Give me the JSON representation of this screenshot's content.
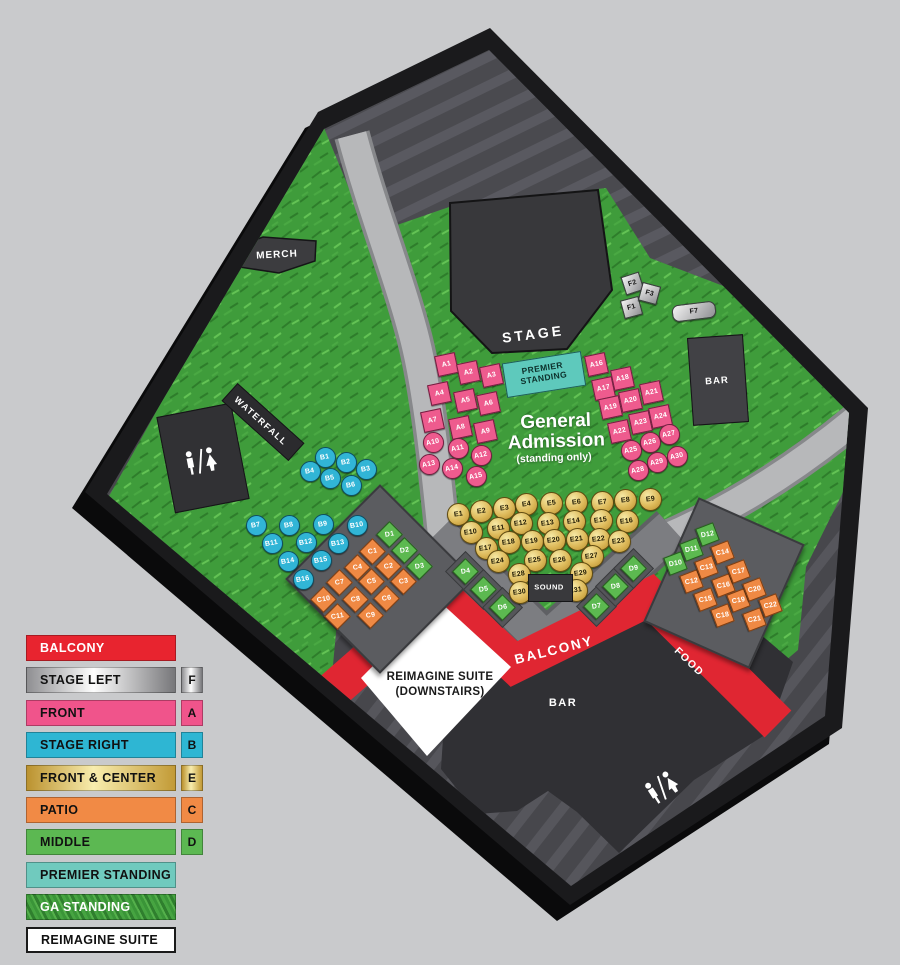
{
  "map": {
    "labels": {
      "merch": "MERCH",
      "stage": "STAGE",
      "premier": "PREMIER STANDING",
      "ga_title": "General Admission",
      "ga_sub": "(standing only)",
      "waterfall": "WATERFALL",
      "bar_upper": "BAR",
      "bar_lower": "BAR",
      "sound": "SOUND",
      "balcony": "BALCONY",
      "food": "FOOD",
      "suite": "REIMAGINE SUITE (DOWNSTAIRS)"
    },
    "colors": {
      "balcony_red": "#e8242f",
      "front_pink": "#ee5b8e",
      "stage_right_cyan": "#31b5d6",
      "front_center_gold": "#ddb959",
      "patio_orange": "#ef8944",
      "middle_green": "#5cb950",
      "premier_teal": "#70cabe",
      "grass_green": "#3f9c3b",
      "stage_left_silver": "#c0c0c2"
    },
    "sections": {
      "front": {
        "name": "FRONT",
        "seats": [
          {
            "id": "A1",
            "x": 446,
            "y": 364,
            "sh": "sq"
          },
          {
            "id": "A2",
            "x": 468,
            "y": 372,
            "sh": "sq"
          },
          {
            "id": "A3",
            "x": 491,
            "y": 375,
            "sh": "sq"
          },
          {
            "id": "A4",
            "x": 439,
            "y": 393,
            "sh": "sq"
          },
          {
            "id": "A5",
            "x": 465,
            "y": 400,
            "sh": "sq"
          },
          {
            "id": "A6",
            "x": 488,
            "y": 403,
            "sh": "sq"
          },
          {
            "id": "A7",
            "x": 432,
            "y": 420,
            "sh": "sq"
          },
          {
            "id": "A8",
            "x": 460,
            "y": 427,
            "sh": "sq"
          },
          {
            "id": "A9",
            "x": 485,
            "y": 431,
            "sh": "sq"
          },
          {
            "id": "A10",
            "x": 433,
            "y": 442,
            "sh": "ci"
          },
          {
            "id": "A11",
            "x": 458,
            "y": 448,
            "sh": "ci"
          },
          {
            "id": "A12",
            "x": 481,
            "y": 455,
            "sh": "ci"
          },
          {
            "id": "A13",
            "x": 429,
            "y": 464,
            "sh": "ci"
          },
          {
            "id": "A14",
            "x": 452,
            "y": 468,
            "sh": "ci"
          },
          {
            "id": "A15",
            "x": 476,
            "y": 476,
            "sh": "ci"
          },
          {
            "id": "A16",
            "x": 596,
            "y": 364,
            "sh": "sq"
          },
          {
            "id": "A17",
            "x": 603,
            "y": 388,
            "sh": "sq"
          },
          {
            "id": "A18",
            "x": 622,
            "y": 378,
            "sh": "sq"
          },
          {
            "id": "A19",
            "x": 610,
            "y": 407,
            "sh": "sq"
          },
          {
            "id": "A20",
            "x": 630,
            "y": 400,
            "sh": "sq"
          },
          {
            "id": "A21",
            "x": 651,
            "y": 392,
            "sh": "sq"
          },
          {
            "id": "A22",
            "x": 619,
            "y": 431,
            "sh": "sq"
          },
          {
            "id": "A23",
            "x": 640,
            "y": 422,
            "sh": "sq"
          },
          {
            "id": "A24",
            "x": 660,
            "y": 416,
            "sh": "sq"
          },
          {
            "id": "A25",
            "x": 631,
            "y": 450,
            "sh": "ci"
          },
          {
            "id": "A26",
            "x": 650,
            "y": 442,
            "sh": "ci"
          },
          {
            "id": "A27",
            "x": 669,
            "y": 434,
            "sh": "ci"
          },
          {
            "id": "A28",
            "x": 638,
            "y": 470,
            "sh": "ci"
          },
          {
            "id": "A29",
            "x": 657,
            "y": 462,
            "sh": "ci"
          },
          {
            "id": "A30",
            "x": 677,
            "y": 456,
            "sh": "ci"
          }
        ]
      },
      "stage_right": {
        "name": "STAGE RIGHT",
        "seats": [
          {
            "id": "B1",
            "x": 325,
            "y": 457
          },
          {
            "id": "B2",
            "x": 346,
            "y": 462
          },
          {
            "id": "B3",
            "x": 366,
            "y": 469
          },
          {
            "id": "B4",
            "x": 310,
            "y": 471
          },
          {
            "id": "B5",
            "x": 330,
            "y": 478
          },
          {
            "id": "B6",
            "x": 351,
            "y": 485
          },
          {
            "id": "B7",
            "x": 256,
            "y": 525
          },
          {
            "id": "B8",
            "x": 289,
            "y": 525
          },
          {
            "id": "B9",
            "x": 323,
            "y": 524
          },
          {
            "id": "B10",
            "x": 357,
            "y": 525
          },
          {
            "id": "B11",
            "x": 272,
            "y": 543
          },
          {
            "id": "B12",
            "x": 306,
            "y": 542
          },
          {
            "id": "B13",
            "x": 338,
            "y": 543
          },
          {
            "id": "B14",
            "x": 288,
            "y": 561
          },
          {
            "id": "B15",
            "x": 321,
            "y": 560
          },
          {
            "id": "B16",
            "x": 303,
            "y": 579
          }
        ]
      },
      "front_center": {
        "name": "FRONT & CENTER",
        "seats": [
          {
            "id": "E1",
            "x": 458,
            "y": 514
          },
          {
            "id": "E2",
            "x": 481,
            "y": 511
          },
          {
            "id": "E3",
            "x": 504,
            "y": 508
          },
          {
            "id": "E4",
            "x": 526,
            "y": 504
          },
          {
            "id": "E5",
            "x": 551,
            "y": 503
          },
          {
            "id": "E6",
            "x": 576,
            "y": 502
          },
          {
            "id": "E7",
            "x": 602,
            "y": 502
          },
          {
            "id": "E8",
            "x": 625,
            "y": 500
          },
          {
            "id": "E9",
            "x": 650,
            "y": 499
          },
          {
            "id": "E10",
            "x": 471,
            "y": 532
          },
          {
            "id": "E11",
            "x": 498,
            "y": 528
          },
          {
            "id": "E12",
            "x": 521,
            "y": 523
          },
          {
            "id": "E13",
            "x": 548,
            "y": 523
          },
          {
            "id": "E14",
            "x": 574,
            "y": 521
          },
          {
            "id": "E15",
            "x": 601,
            "y": 520
          },
          {
            "id": "E16",
            "x": 627,
            "y": 521
          },
          {
            "id": "E17",
            "x": 486,
            "y": 548
          },
          {
            "id": "E18",
            "x": 509,
            "y": 542
          },
          {
            "id": "E19",
            "x": 532,
            "y": 541
          },
          {
            "id": "E20",
            "x": 554,
            "y": 540
          },
          {
            "id": "E21",
            "x": 577,
            "y": 539
          },
          {
            "id": "E22",
            "x": 599,
            "y": 539
          },
          {
            "id": "E23",
            "x": 619,
            "y": 541
          },
          {
            "id": "E24",
            "x": 498,
            "y": 561
          },
          {
            "id": "E25",
            "x": 535,
            "y": 560
          },
          {
            "id": "E26",
            "x": 560,
            "y": 560
          },
          {
            "id": "E27",
            "x": 592,
            "y": 556
          },
          {
            "id": "E28",
            "x": 519,
            "y": 574
          },
          {
            "id": "E29",
            "x": 581,
            "y": 573
          },
          {
            "id": "E30",
            "x": 520,
            "y": 592
          },
          {
            "id": "E31",
            "x": 576,
            "y": 590
          }
        ]
      },
      "patio": {
        "name": "PATIO",
        "seats": [
          {
            "id": "C1",
            "x": 372,
            "y": 551
          },
          {
            "id": "C2",
            "x": 388,
            "y": 566
          },
          {
            "id": "C3",
            "x": 403,
            "y": 581
          },
          {
            "id": "C4",
            "x": 357,
            "y": 567
          },
          {
            "id": "C5",
            "x": 371,
            "y": 581
          },
          {
            "id": "C6",
            "x": 386,
            "y": 598
          },
          {
            "id": "C7",
            "x": 339,
            "y": 582
          },
          {
            "id": "C8",
            "x": 355,
            "y": 599
          },
          {
            "id": "C9",
            "x": 370,
            "y": 615
          },
          {
            "id": "C10",
            "x": 323,
            "y": 599
          },
          {
            "id": "C11",
            "x": 337,
            "y": 616
          },
          {
            "id": "C12",
            "x": 691,
            "y": 581,
            "rot": 69
          },
          {
            "id": "C13",
            "x": 706,
            "y": 567,
            "rot": 69
          },
          {
            "id": "C14",
            "x": 722,
            "y": 552,
            "rot": 69
          },
          {
            "id": "C15",
            "x": 705,
            "y": 599,
            "rot": 69
          },
          {
            "id": "C16",
            "x": 723,
            "y": 585,
            "rot": 69
          },
          {
            "id": "C17",
            "x": 738,
            "y": 571,
            "rot": 69
          },
          {
            "id": "C18",
            "x": 722,
            "y": 615,
            "rot": 69
          },
          {
            "id": "C19",
            "x": 738,
            "y": 600,
            "rot": 69
          },
          {
            "id": "C20",
            "x": 754,
            "y": 589,
            "rot": 69
          },
          {
            "id": "C21",
            "x": 754,
            "y": 619,
            "rot": 69
          },
          {
            "id": "C22",
            "x": 770,
            "y": 605,
            "rot": 69
          }
        ]
      },
      "middle": {
        "name": "MIDDLE",
        "seats": [
          {
            "id": "D1",
            "x": 389,
            "y": 534
          },
          {
            "id": "D2",
            "x": 404,
            "y": 550
          },
          {
            "id": "D3",
            "x": 419,
            "y": 566
          },
          {
            "id": "D4",
            "x": 465,
            "y": 571,
            "tile": true
          },
          {
            "id": "D5",
            "x": 483,
            "y": 589,
            "tile": true
          },
          {
            "id": "D6",
            "x": 502,
            "y": 607,
            "tile": true
          },
          {
            "id": "D7",
            "x": 596,
            "y": 606,
            "tile": true
          },
          {
            "id": "D8",
            "x": 615,
            "y": 586,
            "tile": true
          },
          {
            "id": "D9",
            "x": 633,
            "y": 568,
            "tile": true
          },
          {
            "id": "D10",
            "x": 675,
            "y": 563,
            "rot": 69
          },
          {
            "id": "D11",
            "x": 691,
            "y": 549,
            "rot": 69
          },
          {
            "id": "D12",
            "x": 707,
            "y": 534,
            "rot": 69
          }
        ]
      },
      "stage_left": {
        "name": "STAGE LEFT",
        "seats": [
          {
            "id": "F1",
            "x": 631,
            "y": 307,
            "sh": "sq",
            "rot": -15
          },
          {
            "id": "F2",
            "x": 632,
            "y": 283,
            "sh": "sq",
            "rot": -18
          },
          {
            "id": "F3",
            "x": 649,
            "y": 293,
            "sh": "sq",
            "rot": 15
          },
          {
            "id": "F7",
            "x": 694,
            "y": 311,
            "sh": "wide",
            "rot": -7
          }
        ]
      }
    }
  },
  "legend": {
    "items": [
      {
        "label": "BALCONY",
        "style": "red"
      },
      {
        "label": "STAGE LEFT",
        "style": "silver",
        "letter": "F"
      },
      {
        "label": "FRONT",
        "style": "pink",
        "letter": "A"
      },
      {
        "label": "STAGE RIGHT",
        "style": "cyan",
        "letter": "B"
      },
      {
        "label": "FRONT & CENTER",
        "style": "gold",
        "letter": "E"
      },
      {
        "label": "PATIO",
        "style": "orange",
        "letter": "C"
      },
      {
        "label": "MIDDLE",
        "style": "green",
        "letter": "D"
      },
      {
        "label": "PREMIER STANDING",
        "style": "teal"
      },
      {
        "label": "GA STANDING",
        "style": "grass"
      },
      {
        "label": "REIMAGINE SUITE",
        "style": "white"
      }
    ]
  }
}
